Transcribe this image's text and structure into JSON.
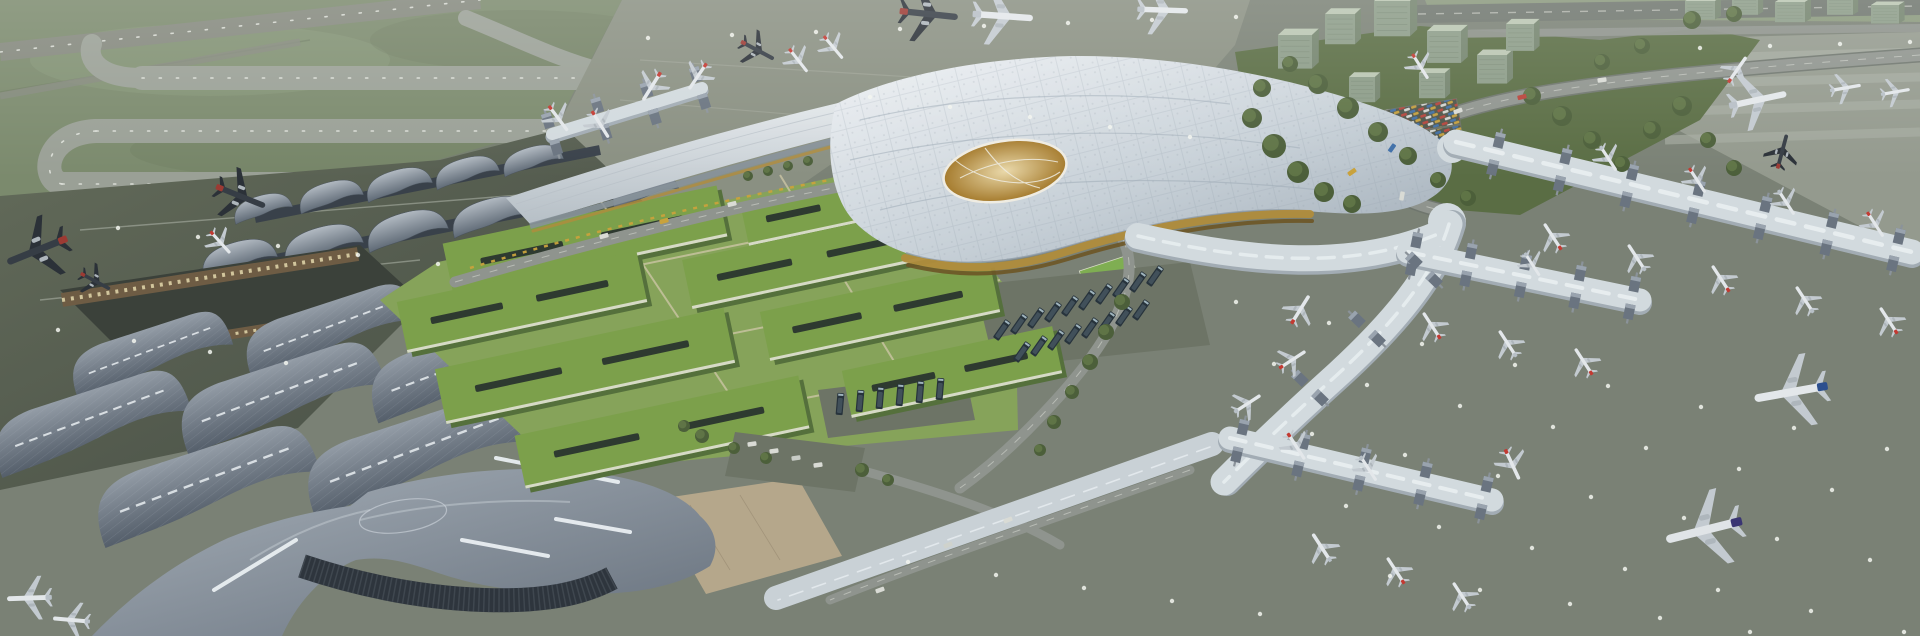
{
  "scene": {
    "type": "architectural-aerial-rendering",
    "subject": "airport-terminal-complex-aerial-rendering",
    "description": "Aerial CGI rendering of a large airport: a flowing silver main terminal canopy with an oval oculus, a district of green-roofed buildings, wave-roofed legacy terminal halls at lower left, grass airfield with looping taxiways at upper left, and long gate concourses with parked airliners on gray aprons to the right.",
    "planes_format": "[x, y, rotation_deg, scale, livery]",
    "planes": [
      [
        558,
        118,
        143,
        0.8,
        "redtail"
      ],
      [
        600,
        124,
        148,
        0.8,
        "redtail"
      ],
      [
        652,
        86,
        212,
        0.85,
        "redtail"
      ],
      [
        698,
        76,
        214,
        0.8,
        "redtail"
      ],
      [
        757,
        50,
        118,
        0.95,
        "dark"
      ],
      [
        798,
        60,
        142,
        0.75,
        "redtail"
      ],
      [
        833,
        47,
        140,
        0.75,
        "redtail"
      ],
      [
        928,
        14,
        96,
        1.5,
        "dark"
      ],
      [
        1002,
        16,
        94,
        1.55,
        "white"
      ],
      [
        1162,
        10,
        92,
        1.3,
        "white"
      ],
      [
        1420,
        66,
        148,
        0.75,
        "redtail"
      ],
      [
        38,
        250,
        248,
        1.65,
        "dark"
      ],
      [
        240,
        196,
        112,
        1.35,
        "dark"
      ],
      [
        220,
        242,
        138,
        0.75,
        "redtail"
      ],
      [
        95,
        281,
        118,
        0.85,
        "dark"
      ],
      [
        30,
        598,
        268,
        1.15,
        "white"
      ],
      [
        72,
        620,
        275,
        0.95,
        "white"
      ],
      [
        1300,
        310,
        32,
        0.85,
        "redtail"
      ],
      [
        1553,
        237,
        327,
        0.8,
        "redtail"
      ],
      [
        1637,
        258,
        327,
        0.8,
        "white"
      ],
      [
        1721,
        279,
        327,
        0.8,
        "redtail"
      ],
      [
        1805,
        300,
        327,
        0.8,
        "white"
      ],
      [
        1889,
        321,
        327,
        0.8,
        "redtail"
      ],
      [
        1608,
        158,
        147,
        0.75,
        "white"
      ],
      [
        1697,
        180,
        147,
        0.75,
        "redtail"
      ],
      [
        1786,
        202,
        147,
        0.75,
        "white"
      ],
      [
        1875,
        224,
        147,
        0.75,
        "redtail"
      ],
      [
        1432,
        326,
        327,
        0.8,
        "redtail"
      ],
      [
        1508,
        344,
        327,
        0.8,
        "white"
      ],
      [
        1584,
        362,
        327,
        0.8,
        "redtail"
      ],
      [
        1532,
        264,
        147,
        0.7,
        "white"
      ],
      [
        1296,
        446,
        147,
        0.8,
        "redtail"
      ],
      [
        1368,
        468,
        147,
        0.75,
        "white"
      ],
      [
        1512,
        464,
        155,
        0.85,
        "redtail"
      ],
      [
        1322,
        548,
        327,
        0.85,
        "white"
      ],
      [
        1396,
        571,
        327,
        0.8,
        "redtail"
      ],
      [
        1462,
        596,
        327,
        0.8,
        "white"
      ],
      [
        1292,
        360,
        57,
        0.8,
        "redtail"
      ],
      [
        1247,
        404,
        57,
        0.8,
        "white"
      ],
      [
        1792,
        392,
        260,
        1.9,
        "blue"
      ],
      [
        1705,
        530,
        256,
        2.0,
        "purple"
      ],
      [
        1737,
        70,
        35,
        0.8,
        "redtail"
      ],
      [
        1757,
        100,
        78,
        1.5,
        "white"
      ],
      [
        1845,
        88,
        80,
        0.8,
        "white"
      ],
      [
        1895,
        92,
        80,
        0.75,
        "white"
      ],
      [
        1782,
        152,
        15,
        0.9,
        "dark"
      ]
    ],
    "buses_format": "[x, y, rotation_deg]",
    "buses": [
      [
        1002,
        330,
        -55
      ],
      [
        1019,
        324,
        -55
      ],
      [
        1036,
        318,
        -55
      ],
      [
        1053,
        312,
        -55
      ],
      [
        1070,
        306,
        -55
      ],
      [
        1087,
        300,
        -55
      ],
      [
        1104,
        294,
        -55
      ],
      [
        1121,
        288,
        -55
      ],
      [
        1138,
        282,
        -55
      ],
      [
        1155,
        276,
        -55
      ],
      [
        1022,
        352,
        -55
      ],
      [
        1039,
        346,
        -55
      ],
      [
        1056,
        340,
        -55
      ],
      [
        1073,
        334,
        -55
      ],
      [
        1090,
        328,
        -55
      ],
      [
        1107,
        322,
        -55
      ],
      [
        1124,
        316,
        -55
      ],
      [
        1141,
        310,
        -55
      ],
      [
        840,
        404,
        -85
      ],
      [
        860,
        401,
        -85
      ],
      [
        880,
        398,
        -85
      ],
      [
        900,
        395,
        -85
      ],
      [
        920,
        392,
        -85
      ],
      [
        940,
        389,
        -85
      ]
    ],
    "trees_format": "[x, y, radius]",
    "trees": [
      [
        1252,
        118,
        10
      ],
      [
        1274,
        146,
        12
      ],
      [
        1298,
        172,
        11
      ],
      [
        1324,
        192,
        10
      ],
      [
        1352,
        204,
        9
      ],
      [
        1262,
        88,
        9
      ],
      [
        1290,
        64,
        8
      ],
      [
        1318,
        84,
        10
      ],
      [
        1348,
        108,
        11
      ],
      [
        1378,
        132,
        10
      ],
      [
        1408,
        156,
        9
      ],
      [
        1438,
        180,
        8
      ],
      [
        1468,
        198,
        8
      ],
      [
        1532,
        96,
        9
      ],
      [
        1562,
        116,
        10
      ],
      [
        1592,
        140,
        9
      ],
      [
        1622,
        164,
        8
      ],
      [
        1652,
        130,
        9
      ],
      [
        1682,
        106,
        10
      ],
      [
        1708,
        140,
        8
      ],
      [
        1734,
        168,
        8
      ],
      [
        1602,
        62,
        8
      ],
      [
        1642,
        46,
        8
      ],
      [
        1692,
        20,
        9
      ],
      [
        1734,
        14,
        8
      ],
      [
        702,
        436,
        7
      ],
      [
        734,
        448,
        6
      ],
      [
        766,
        458,
        6
      ],
      [
        684,
        426,
        6
      ],
      [
        862,
        470,
        7
      ],
      [
        888,
        480,
        6
      ],
      [
        1122,
        302,
        8
      ],
      [
        1106,
        332,
        8
      ],
      [
        1090,
        362,
        8
      ],
      [
        1072,
        392,
        7
      ],
      [
        1054,
        422,
        7
      ],
      [
        1040,
        450,
        6
      ],
      [
        748,
        176,
        5
      ],
      [
        768,
        171,
        5
      ],
      [
        788,
        166,
        5
      ],
      [
        808,
        161,
        5
      ]
    ],
    "office_buildings_format": "[x, y, width, height]",
    "office_buildings": [
      [
        1295,
        55,
        34,
        40
      ],
      [
        1340,
        32,
        30,
        36
      ],
      [
        1392,
        22,
        36,
        42
      ],
      [
        1444,
        50,
        34,
        38
      ],
      [
        1492,
        72,
        30,
        34
      ],
      [
        1432,
        88,
        26,
        30
      ],
      [
        1362,
        92,
        26,
        30
      ],
      [
        1520,
        40,
        28,
        32
      ],
      [
        1700,
        12,
        30,
        22
      ],
      [
        1745,
        8,
        26,
        20
      ],
      [
        1790,
        14,
        30,
        24
      ],
      [
        1840,
        8,
        26,
        20
      ],
      [
        1885,
        16,
        28,
        22
      ]
    ],
    "green_roofs_format": "[cx, cy, width, height, rotation_deg]",
    "green_roofs": [
      [
        835,
        205,
        185,
        44,
        -12
      ],
      [
        585,
        240,
        280,
        52,
        -12
      ],
      [
        812,
        258,
        255,
        50,
        -12
      ],
      [
        522,
        302,
        245,
        52,
        -12
      ],
      [
        880,
        312,
        235,
        50,
        -12
      ],
      [
        585,
        366,
        295,
        56,
        -12
      ],
      [
        952,
        372,
        215,
        48,
        -12
      ],
      [
        662,
        432,
        290,
        54,
        -12
      ]
    ],
    "concourse_gates": {
      "pier": {
        "x1": 552,
        "y1": 134,
        "x2": 700,
        "y2": 88,
        "n": 4
      },
      "a": {
        "x1": 1496,
        "y1": 154,
        "x2": 1896,
        "y2": 250,
        "n": 7
      },
      "b": {
        "x1": 1414,
        "y1": 254,
        "x2": 1632,
        "y2": 298,
        "n": 5
      },
      "c": {
        "x1": 1240,
        "y1": 441,
        "x2": 1484,
        "y2": 498,
        "n": 5
      },
      "spine": {
        "x1": 1310,
        "y1": 388,
        "x2": 1424,
        "y2": 270,
        "n": 3
      }
    },
    "light_rows_format": "[x, y, dx, dy, count]",
    "light_rows": [
      [
        1236,
        302,
        93,
        21,
        8
      ],
      [
        1274,
        364,
        93,
        21,
        8
      ],
      [
        1312,
        434,
        93,
        21,
        7
      ],
      [
        1346,
        506,
        93,
        21,
        7
      ],
      [
        1390,
        576,
        90,
        14,
        6
      ],
      [
        908,
        562,
        88,
        13,
        5
      ],
      [
        648,
        38,
        84,
        -3,
        8
      ],
      [
        870,
        97,
        80,
        10,
        5
      ],
      [
        118,
        228,
        80,
        9,
        5
      ],
      [
        58,
        330,
        76,
        11,
        4
      ],
      [
        1700,
        48,
        70,
        -2,
        4
      ]
    ],
    "vehicles_format": "[x, y, rotation_deg, color]",
    "vehicles": [
      [
        1602,
        80,
        -8,
        "#d9dbd5"
      ],
      [
        1522,
        97,
        -14,
        "#b8433a"
      ],
      [
        1458,
        111,
        -20,
        "#d9dbd5"
      ],
      [
        1392,
        148,
        -55,
        "#3f6fa8"
      ],
      [
        1402,
        196,
        -80,
        "#d9dbd5"
      ],
      [
        1352,
        172,
        -35,
        "#c9a23c"
      ],
      [
        604,
        236,
        -16,
        "#d9dbd5"
      ],
      [
        664,
        221,
        -15,
        "#c9a23c"
      ],
      [
        732,
        204,
        -14,
        "#d9dbd5"
      ],
      [
        1008,
        520,
        -22,
        "#d9dbd5"
      ],
      [
        948,
        545,
        -22,
        "#cfd2cc"
      ],
      [
        752,
        444,
        -8,
        "#d9dbd5"
      ],
      [
        774,
        451,
        -8,
        "#d9dbd5"
      ],
      [
        796,
        458,
        -8,
        "#c8ccc6"
      ],
      [
        818,
        465,
        -8,
        "#d9dbd5"
      ],
      [
        880,
        590,
        -20,
        "#d9dbd5"
      ]
    ]
  },
  "colors": {
    "base_apron": "#7a8175",
    "apron_north": "#8a9082",
    "ne_apron": "#949a8e",
    "grass": "#7b8a6d",
    "grass_dark": "#69785c",
    "grass_light": "#8b9a7d",
    "ne_green": "#5a6d44",
    "taxiway": "#9aa096",
    "runway": "#84887d",
    "dot_line": "#eef0ea",
    "lane": "#a9afa3",
    "lane2": "#9ba094",
    "apron_dark_hi": "#636b5a",
    "apron_dark_lo": "#454c43",
    "road": "#8f948e",
    "road_dash": "#dadcd6",
    "road_edge": "#6f766e",
    "parking_base": "#4e5449",
    "plaza": "#b5a78b",
    "lawn": "#86a35a",
    "lawn_path": "#cbc4a4",
    "field_green": "#7fae52",
    "bus_pad": "#6d7466",
    "green_roof": "#7ca04b",
    "green_roof_side": "#55703c",
    "roof_slit": "#2e3a30",
    "roof_edge": "#d6dac6",
    "courtyard": "#3b413a",
    "arcade": "#6e5c44",
    "arcade_window": "#dcd0a6",
    "curtain": "#2e353d",
    "curtain_line": "#4b545c",
    "skylight": "#e9eef1",
    "ridge": "#c3cbd2",
    "canopy_hi": "#eef1f4",
    "canopy_mid": "#c8d1d8",
    "canopy_lo": "#9fabb6",
    "canopy_grid": "#94a0ab",
    "wing_hi": "#e2e7ea",
    "wing_lo": "#b6bfc6",
    "oculus_hi": "#ead9aa",
    "oculus_lo": "#a57b2d",
    "oculus_web": "#efece2",
    "amber": "#b08c3c",
    "amber_dark": "#6d5526",
    "flower1": "#c9a23c",
    "flower2": "#b8433a",
    "shell_hi": "#b2bac2",
    "shell_lo": "#5d6874",
    "shed_hi": "#949da7",
    "shed_lo": "#545e6a",
    "swoosh_hi": "#a6afb8",
    "swoosh_lo": "#67717d",
    "corridor_roof": "#c9d1d6",
    "corridor_glass": "#87929a",
    "concourse_roof": "#d2dade",
    "concourse_shadow": "#a2acb4",
    "gate_box": "#6a7480",
    "gate_top": "#99a3ae",
    "bridge": "#8b939a",
    "bus_body": "#27333c",
    "bus_roof": "#46565f",
    "bus_glass": "#9fb4bd",
    "tree_dark": "#4c5f3a",
    "tree_light": "#5f7446",
    "bldg_front": "#8c9c88",
    "bldg_top": "#bac6b2",
    "bldg_side": "#74846e",
    "bldg_line": "#6d7d69",
    "light_dot": "#f2f4ee",
    "fence": "#6d7a60",
    "engine": "#aeb6bc",
    "liveries": {
      "white": {
        "body": "#e3e7ea",
        "wing": "#c3cad0",
        "tail": "#b7bfc6"
      },
      "redtail": {
        "body": "#e3e7ea",
        "wing": "#c3cad0",
        "tail": "#c23a32"
      },
      "dark": {
        "body": "#363d45",
        "wing": "#2b3138",
        "tail": "#9c3a33"
      },
      "blue": {
        "body": "#e3e7ea",
        "wing": "#c3cad0",
        "tail": "#2c4f8e"
      },
      "purple": {
        "body": "#e0e4e7",
        "wing": "#c3cad0",
        "tail": "#3a3573"
      }
    }
  }
}
